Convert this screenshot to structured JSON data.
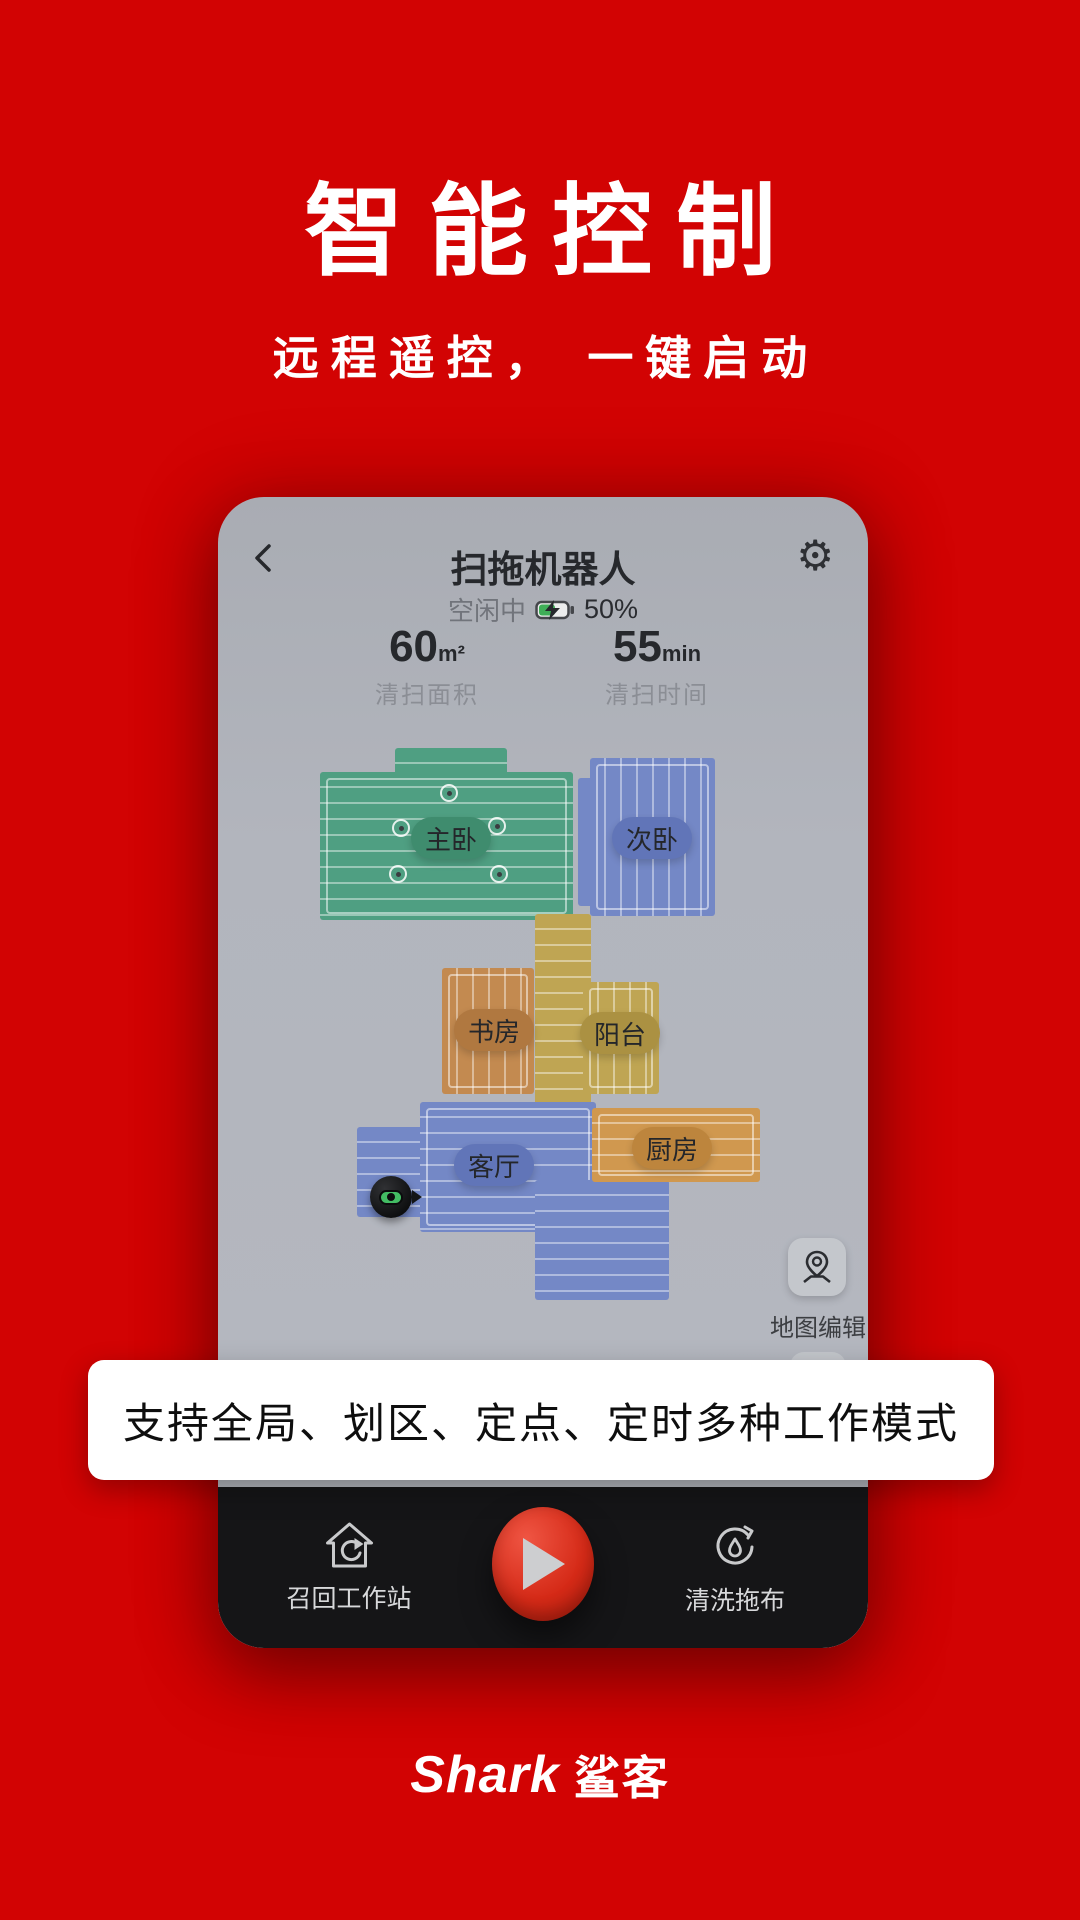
{
  "colors": {
    "background": "#d20303",
    "banner_bg": "#ffffff",
    "play_red": "#cf2010",
    "battery_green": "#3fae57",
    "screen_grey": "#b2b5bd",
    "bar_dark": "#151517"
  },
  "hero": {
    "title": "智能控制",
    "subtitle": "远程遥控， 一键启动"
  },
  "phone": {
    "header": {
      "title": "扫拖机器人",
      "status": "空闲中",
      "battery_percent": "50%"
    },
    "stats": [
      {
        "value": "60",
        "unit": "m²",
        "label": "清扫面积"
      },
      {
        "value": "55",
        "unit": "min",
        "label": "清扫时间"
      }
    ],
    "map": {
      "edit_label": "地图编辑",
      "rooms": [
        {
          "name": "主卧",
          "fill": "#4f9f82",
          "pill": "#3f8c6e"
        },
        {
          "name": "次卧",
          "fill": "#7488c6",
          "pill": "#6175b8"
        },
        {
          "name": "书房",
          "fill": "#c38a50",
          "pill": "#b07840"
        },
        {
          "name": "阳台",
          "fill": "#bfa553",
          "pill": "#ab9142"
        },
        {
          "name": "客厅",
          "fill": "#7488c6",
          "pill": "#6175b8"
        },
        {
          "name": "厨房",
          "fill": "#d0984f",
          "pill": "#bd853d"
        }
      ]
    },
    "banner": "支持全局、划区、定点、定时多种工作模式",
    "controls": {
      "recall": "召回工作站",
      "wash": "清洗拖布"
    }
  },
  "footer": {
    "brand_en": "Shark",
    "brand_cn": "鲨客"
  }
}
